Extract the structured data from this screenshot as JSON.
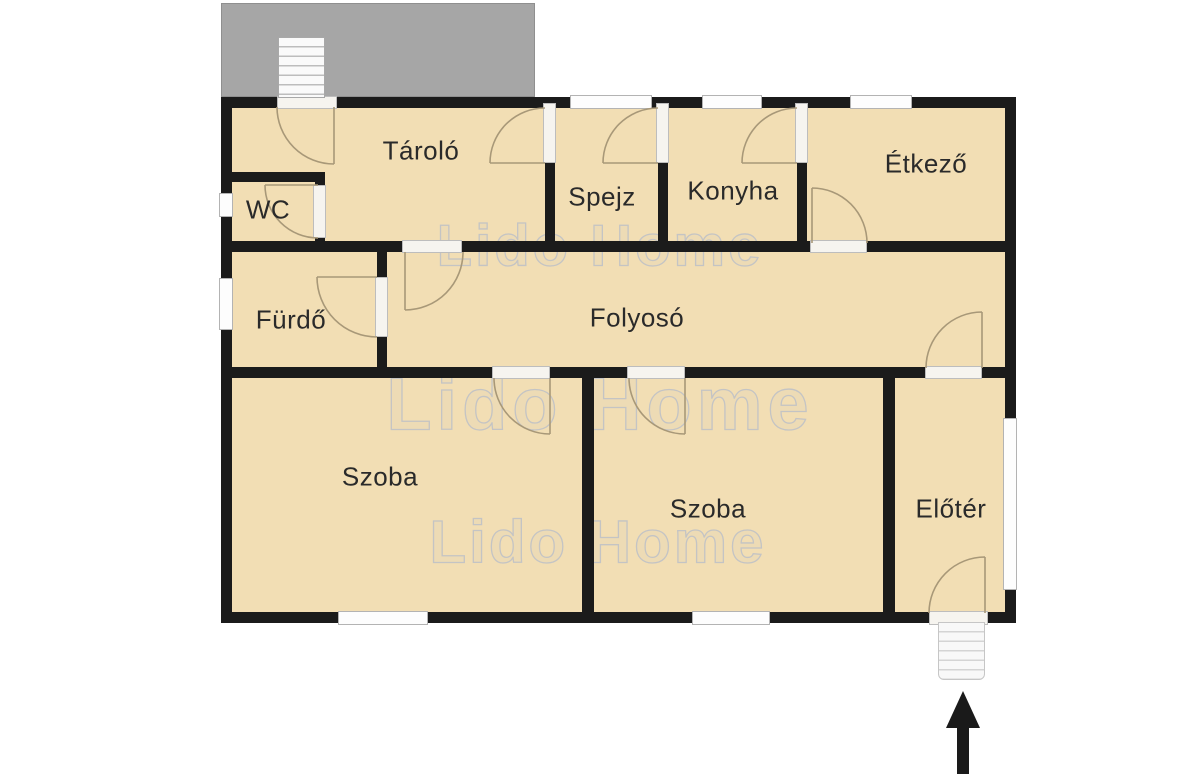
{
  "title": "Floor plan",
  "watermark": {
    "text": "Lido Home"
  },
  "rooms": [
    {
      "id": "tarolo",
      "label": "Tároló"
    },
    {
      "id": "wc",
      "label": "WC"
    },
    {
      "id": "spejz",
      "label": "Spejz"
    },
    {
      "id": "konyha",
      "label": "Konyha"
    },
    {
      "id": "etkezo",
      "label": "Étkező"
    },
    {
      "id": "furdo",
      "label": "Fürdő"
    },
    {
      "id": "folyoso",
      "label": "Folyosó"
    },
    {
      "id": "szoba-1",
      "label": "Szoba"
    },
    {
      "id": "szoba-2",
      "label": "Szoba"
    },
    {
      "id": "eloter",
      "label": "Előtér"
    }
  ],
  "icons": [
    {
      "name": "entrance-arrow-icon",
      "meaning": "entrance direction, pointing up into the house"
    },
    {
      "name": "stairs-top-icon",
      "meaning": "exterior stairs on terrace"
    },
    {
      "name": "stairs-bottom-icon",
      "meaning": "entrance stairs"
    }
  ],
  "colors": {
    "room_fill": "#f2deb4",
    "wall": "#1b1b1b",
    "terrace": "#a6a6a6",
    "watermark": "#c4c4c4",
    "arrow": "#1a1a1a",
    "door_arc": "#a89878",
    "window_frame": "#b3b3b3",
    "label_color": "#2a2a2a"
  }
}
